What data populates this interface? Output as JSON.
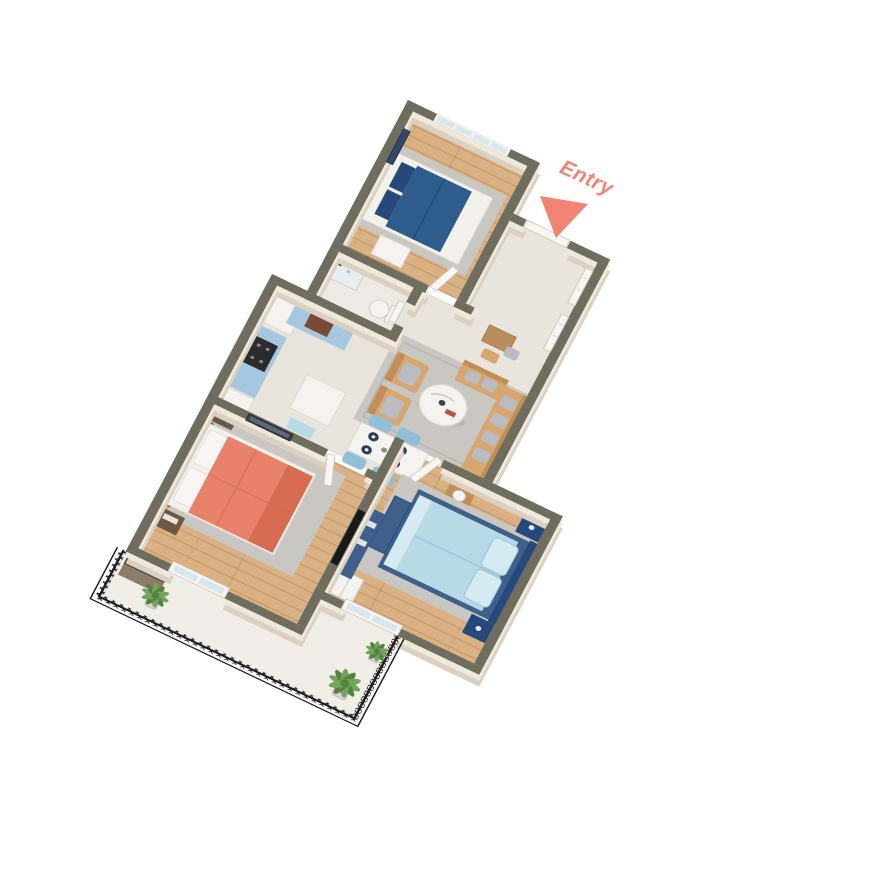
{
  "scene": {
    "description": "3D isometric floor-plan render of a multi-room apartment with balcony",
    "background": "#ffffff"
  },
  "labels": {
    "entry": "Entry"
  },
  "palette": {
    "wall_top": "#6f6d5d",
    "wall_face": "#efe8dc",
    "wall_face_dark": "#dcd1c1",
    "floor_light": "#e9e4dc",
    "floor_bath": "#edeae4",
    "wood": "#d9b183",
    "wood_dark": "#b98a5c",
    "marble": "#f1eee8",
    "rug": "#c9c7c1",
    "rug_dark": "#b5b3ad",
    "navy": "#2e5c8c",
    "navy_dark": "#24497a",
    "frame_white": "#f3f1ec",
    "lightblue": "#b7dbe6",
    "lightblue_dark": "#93c3d4",
    "pillow_light": "#d6eaf1",
    "coral": "#e8826a",
    "coral_dark": "#d4684e",
    "cabinet_blue": "#a5c7e0",
    "cabinet_top": "#56575b",
    "appliance_dark": "#2b2b2e",
    "white": "#f5f3ef",
    "tan": "#d7a76f",
    "tan_dark": "#c08f55",
    "cushion_gray": "#b9bcc0",
    "chair_blue": "#8fc0d8",
    "plate_navy": "#2c3b52",
    "door_white": "#f8f6f3",
    "door_edge": "#d0c9be",
    "glass": "#d8e6ee",
    "tv_black": "#17181a",
    "console_navy": "#3f608a",
    "night_brown": "#6d5747",
    "railing_black": "#1e1e1e",
    "plant": "#74a35c",
    "plant_dark": "#54833f",
    "pot": "#dcd8d0",
    "bench_brown": "#8d7c68",
    "bench_top": "#564d41",
    "wood_console": "#b98e5e",
    "art_navy": "#32486b",
    "art_dark": "#3c3f46",
    "entry": "#f08474"
  },
  "rooms": [
    {
      "name": "bedroom-top",
      "floor": "wood",
      "items": [
        "double-bed-navy",
        "area-rug",
        "wall-art",
        "window",
        "desk"
      ]
    },
    {
      "name": "bathroom",
      "floor": "tile",
      "items": [
        "toilet",
        "shower"
      ]
    },
    {
      "name": "entry-hall",
      "floor": "tile",
      "items": [
        "closet-door",
        "closet-door",
        "wood-console",
        "stool"
      ]
    },
    {
      "name": "kitchen",
      "floor": "tile",
      "items": [
        "fridge",
        "blue-cabinets",
        "stove",
        "island",
        "mat"
      ]
    },
    {
      "name": "living-dining",
      "floor": "tile",
      "items": [
        "sectional-sofa",
        "armchair",
        "armchair",
        "round-coffee-table",
        "side-table-lamp",
        "dining-table",
        "dining-chairs"
      ]
    },
    {
      "name": "bedroom-coral",
      "floor": "wood",
      "items": [
        "double-bed-coral",
        "nightstand",
        "nightstand",
        "wall-art",
        "area-rug",
        "balcony-door"
      ]
    },
    {
      "name": "bedroom-blue",
      "floor": "wood",
      "items": [
        "double-bed-lightblue",
        "nightstand",
        "nightstand",
        "bench",
        "tv",
        "tv-console",
        "wardrobe",
        "area-rug",
        "balcony-door"
      ]
    },
    {
      "name": "balcony",
      "floor": "marble",
      "items": [
        "railing",
        "plant",
        "plant",
        "plant",
        "bench-brown"
      ]
    }
  ]
}
